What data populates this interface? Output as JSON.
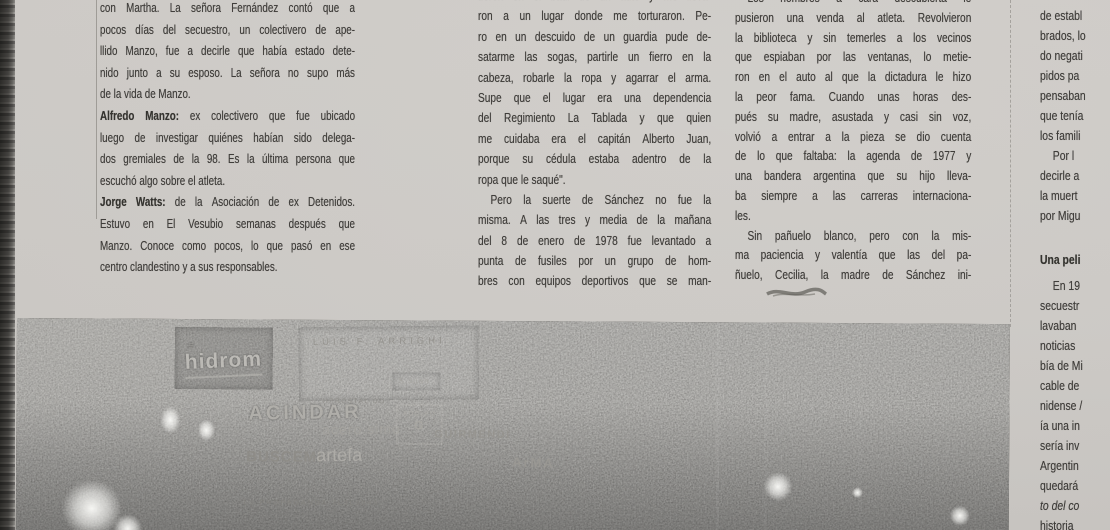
{
  "columns": {
    "left": {
      "lines": [
        {
          "t": "con Martha. La señora Fernández contó que a"
        },
        {
          "t": "pocos días del secuestro, un colectivero de ape-"
        },
        {
          "t": "llido Manzo, fue a decirle que había estado dete-"
        },
        {
          "t": "nido junto a su esposo. La señora no supo más"
        },
        {
          "t": "de la vida de Manzo.",
          "eop": true
        },
        {
          "pre": "Alfredo Manzo:",
          "t": " ex colectivero que fue ubicado"
        },
        {
          "t": "luego de investigar quiénes habían sido delega-"
        },
        {
          "t": "dos gremiales de la 98. Es la última persona que"
        },
        {
          "t": "escuchó algo sobre el atleta.",
          "eop": true
        },
        {
          "pre": "Jorge Watts:",
          "t": " de la Asociación de ex Detenidos."
        },
        {
          "t": "Estuvo en El Vesubio semanas después que"
        },
        {
          "t": "Manzo. Conoce como pocos, lo que pasó en ese"
        },
        {
          "t": "centro clandestino y a sus responsables.",
          "eop": true
        }
      ]
    },
    "middle": {
      "lines": [
        {
          "t": "tieron en el baúl de un auto y me lleva-"
        },
        {
          "t": "ron a un lugar donde me torturaron. Pe-"
        },
        {
          "t": "ro en un descuido de un guardia pude de-"
        },
        {
          "t": "satarme las sogas, partirle un fierro en la"
        },
        {
          "t": "cabeza, robarle la ropa y agarrar el arma."
        },
        {
          "t": "Supe que el lugar era una dependencia"
        },
        {
          "t": "del Regimiento La Tablada y que quien"
        },
        {
          "t": "me cuidaba era el capitán Alberto Juan,"
        },
        {
          "t": "porque su cédula estaba adentro de la"
        },
        {
          "t": "ropa que le saqué\".",
          "eop": true
        },
        {
          "t": "Pero la suerte de Sánchez no fue la",
          "indent": true
        },
        {
          "t": "misma. A las tres y media de la mañana"
        },
        {
          "t": "del 8 de enero de 1978 fue levantado a"
        },
        {
          "t": "punta de fusiles por un grupo de hom-"
        },
        {
          "t": "bres con equipos deportivos que se man-"
        }
      ]
    },
    "right": {
      "lines": [
        {
          "t": "Los hombres a cara descubierta le",
          "indent": true
        },
        {
          "t": "pusieron una venda al atleta. Revolvieron"
        },
        {
          "t": "la biblioteca y sin temerles a los vecinos"
        },
        {
          "t": "que espiaban por las ventanas, lo metie-"
        },
        {
          "t": "ron en el auto al que la dictadura le hizo"
        },
        {
          "t": "la peor fama. Cuando unas horas des-"
        },
        {
          "t": "pués su madre, asustada y casi sin voz,"
        },
        {
          "t": "volvió a entrar a la pieza se dio cuenta"
        },
        {
          "t": "de lo que faltaba: la agenda de 1977 y"
        },
        {
          "t": "una bandera argentina que su hijo lleva-"
        },
        {
          "t": "ba siempre a las carreras internaciona-"
        },
        {
          "t": "les.",
          "eop": true
        },
        {
          "t": "Sin pañuelo blanco, pero con la mis-",
          "indent": true
        },
        {
          "t": "ma paciencia y valentía que las del pa-"
        },
        {
          "t": "ñuelo, Cecilia, la madre de Sánchez ini-"
        }
      ]
    },
    "edge": {
      "lines": [
        {
          "t": "de establ",
          "eop": true
        },
        {
          "t": "brados, lo",
          "eop": true
        },
        {
          "t": "do negati",
          "eop": true
        },
        {
          "t": "pidos pa",
          "eop": true
        },
        {
          "t": "pensaban",
          "eop": true
        },
        {
          "t": "que tenía",
          "eop": true
        },
        {
          "t": "los famili",
          "eop": true
        },
        {
          "t": "Por l",
          "indent": true,
          "eop": true
        },
        {
          "t": "decirle a",
          "eop": true
        },
        {
          "t": "la muert",
          "eop": true
        },
        {
          "t": "por Migu",
          "eop": true
        },
        {
          "t": "",
          "eop": true
        },
        {
          "t": "Una peli",
          "style": "b",
          "eop": true
        },
        {
          "t": "En 19",
          "indent": true,
          "eop": true
        },
        {
          "t": "secuestr",
          "eop": true
        },
        {
          "t": "lavaban",
          "eop": true
        },
        {
          "t": "noticias",
          "eop": true
        },
        {
          "t": "bía de Mi",
          "eop": true
        },
        {
          "t": "cable de",
          "eop": true
        },
        {
          "t": "nidense /",
          "eop": true
        },
        {
          "t": "ía una in",
          "eop": true
        },
        {
          "t": "sería inv",
          "eop": true
        },
        {
          "t": "Argentin",
          "eop": true
        },
        {
          "t": "quedará",
          "eop": true
        },
        {
          "t": "to del co",
          "style": "i",
          "eop": true
        },
        {
          "t": "historia",
          "eop": true
        }
      ]
    }
  },
  "photo": {
    "signs": [
      {
        "id": "hidrom",
        "t": "hidrom"
      },
      {
        "id": "arrighi",
        "t": "LUIS F. ARRIGHI"
      },
      {
        "id": "sjuan",
        "t": "S.Juan"
      },
      {
        "id": "acindar",
        "t": "ACINDAR"
      },
      {
        "id": "prostal",
        "t": "IIPROSTAL OO"
      },
      {
        "id": "acero",
        "t": "acero simo"
      },
      {
        "id": "adolfo-top",
        "t": "ADOLFO"
      },
      {
        "id": "adolfo-g",
        "t": "G"
      },
      {
        "id": "guirmendi",
        "t": "GUIRMENDI"
      },
      {
        "id": "buscemi",
        "t": "BUSCEMI"
      },
      {
        "id": "artefa",
        "t": "artefa"
      },
      {
        "id": "arma",
        "t": "ArMA"
      },
      {
        "id": "credit",
        "t": "L2 PROPAGANDA 7L3L3043"
      }
    ]
  }
}
